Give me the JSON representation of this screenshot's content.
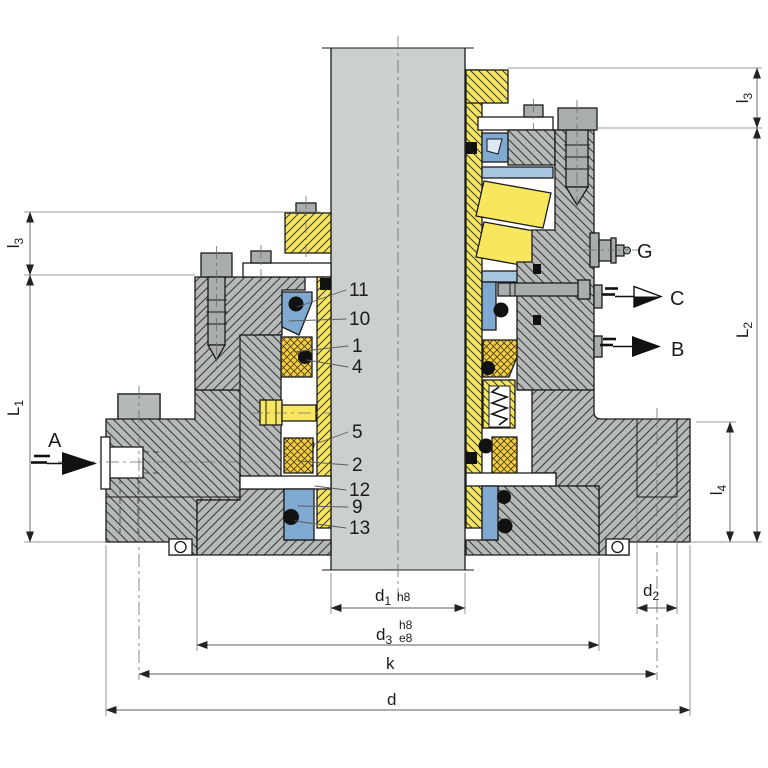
{
  "dimensions": {
    "l3_left": {
      "sym": "l",
      "sub": "3"
    },
    "L1": {
      "sym": "L",
      "sub": "1"
    },
    "l3_right": {
      "sym": "l",
      "sub": "3"
    },
    "L2": {
      "sym": "L",
      "sub": "2"
    },
    "l4": {
      "sym": "l",
      "sub": "4"
    },
    "d1": {
      "sym": "d",
      "sub": "1",
      "tol": "h8"
    },
    "d3": {
      "sym": "d",
      "sub": "3",
      "tol_upper": "h8",
      "tol_lower": "e8"
    },
    "d2": {
      "sym": "d",
      "sub": "2"
    },
    "k": {
      "sym": "k"
    },
    "d": {
      "sym": "d"
    }
  },
  "ports": {
    "a": "A",
    "b": "B",
    "c": "C",
    "g": "G"
  },
  "part_numbers": [
    "11",
    "10",
    "1",
    "4",
    "5",
    "2",
    "12",
    "9",
    "13"
  ],
  "colors": {
    "shaft_gray": "#cbcfcd",
    "housing_gray": "#b5b9b8",
    "part_gray": "#a9adad",
    "sleeve_yellow": "#f8e75e",
    "seal_face_yellow": "#f3cf3f",
    "elastomer_blue": "#7fa9d1",
    "bearing_blue": "#a8c6e0",
    "line_black": "#1b1b1b"
  }
}
